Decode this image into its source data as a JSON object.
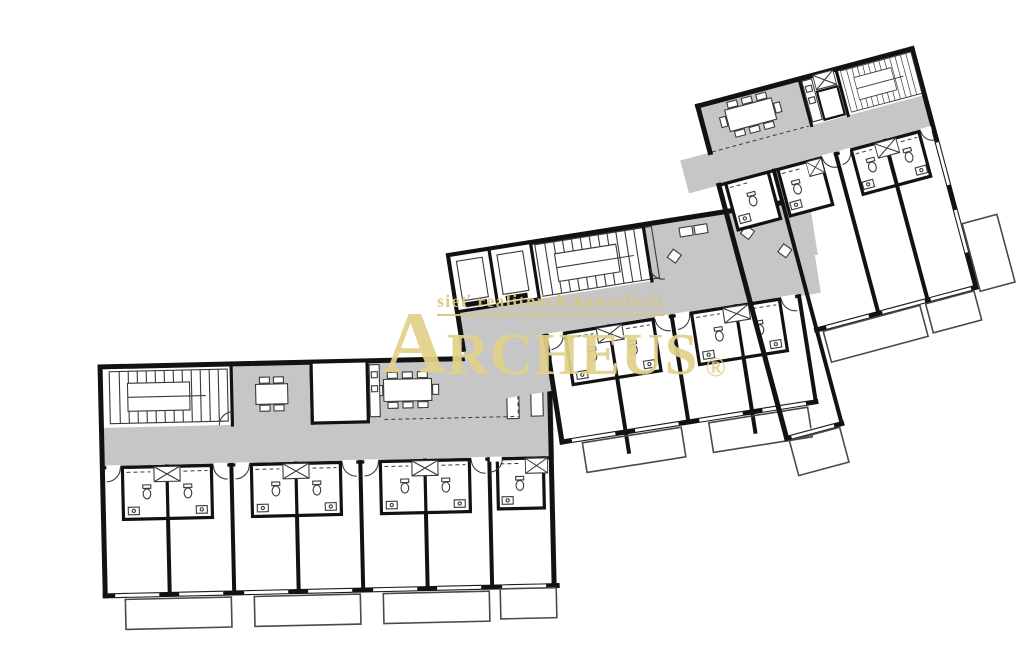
{
  "watermark": {
    "tagline": "sieť realitných kancelárií",
    "brand_initial": "A",
    "brand_rest": "RCHEUS",
    "registered": "®"
  },
  "palette": {
    "background": "#ffffff",
    "walls": "#121212",
    "common_area": "#c6c6c6",
    "thin_line": "#3a3a3a",
    "watermark_gold": "#e3d18a",
    "watermark_gold_dark": "#d9c678"
  },
  "plan": {
    "type": "apartment-building-floor-plan",
    "wings": [
      {
        "id": "wing-a",
        "units": 7,
        "balconies": 4,
        "common_features": [
          "staircase",
          "meeting-table-4-chairs",
          "storage-room",
          "dining-table-8-chairs",
          "corridor"
        ]
      },
      {
        "id": "wing-b",
        "units": 4,
        "balconies": 2,
        "common_features": [
          "elevators",
          "staircase",
          "lounge-seating",
          "corridor"
        ]
      },
      {
        "id": "wing-c",
        "units": 4,
        "balconies": 3,
        "common_features": [
          "dining-table-8-chairs",
          "shaft",
          "staircase",
          "corridor"
        ]
      }
    ],
    "unit_fixtures": [
      "wc",
      "sink",
      "shaft",
      "entry-door",
      "window",
      "balcony"
    ]
  }
}
